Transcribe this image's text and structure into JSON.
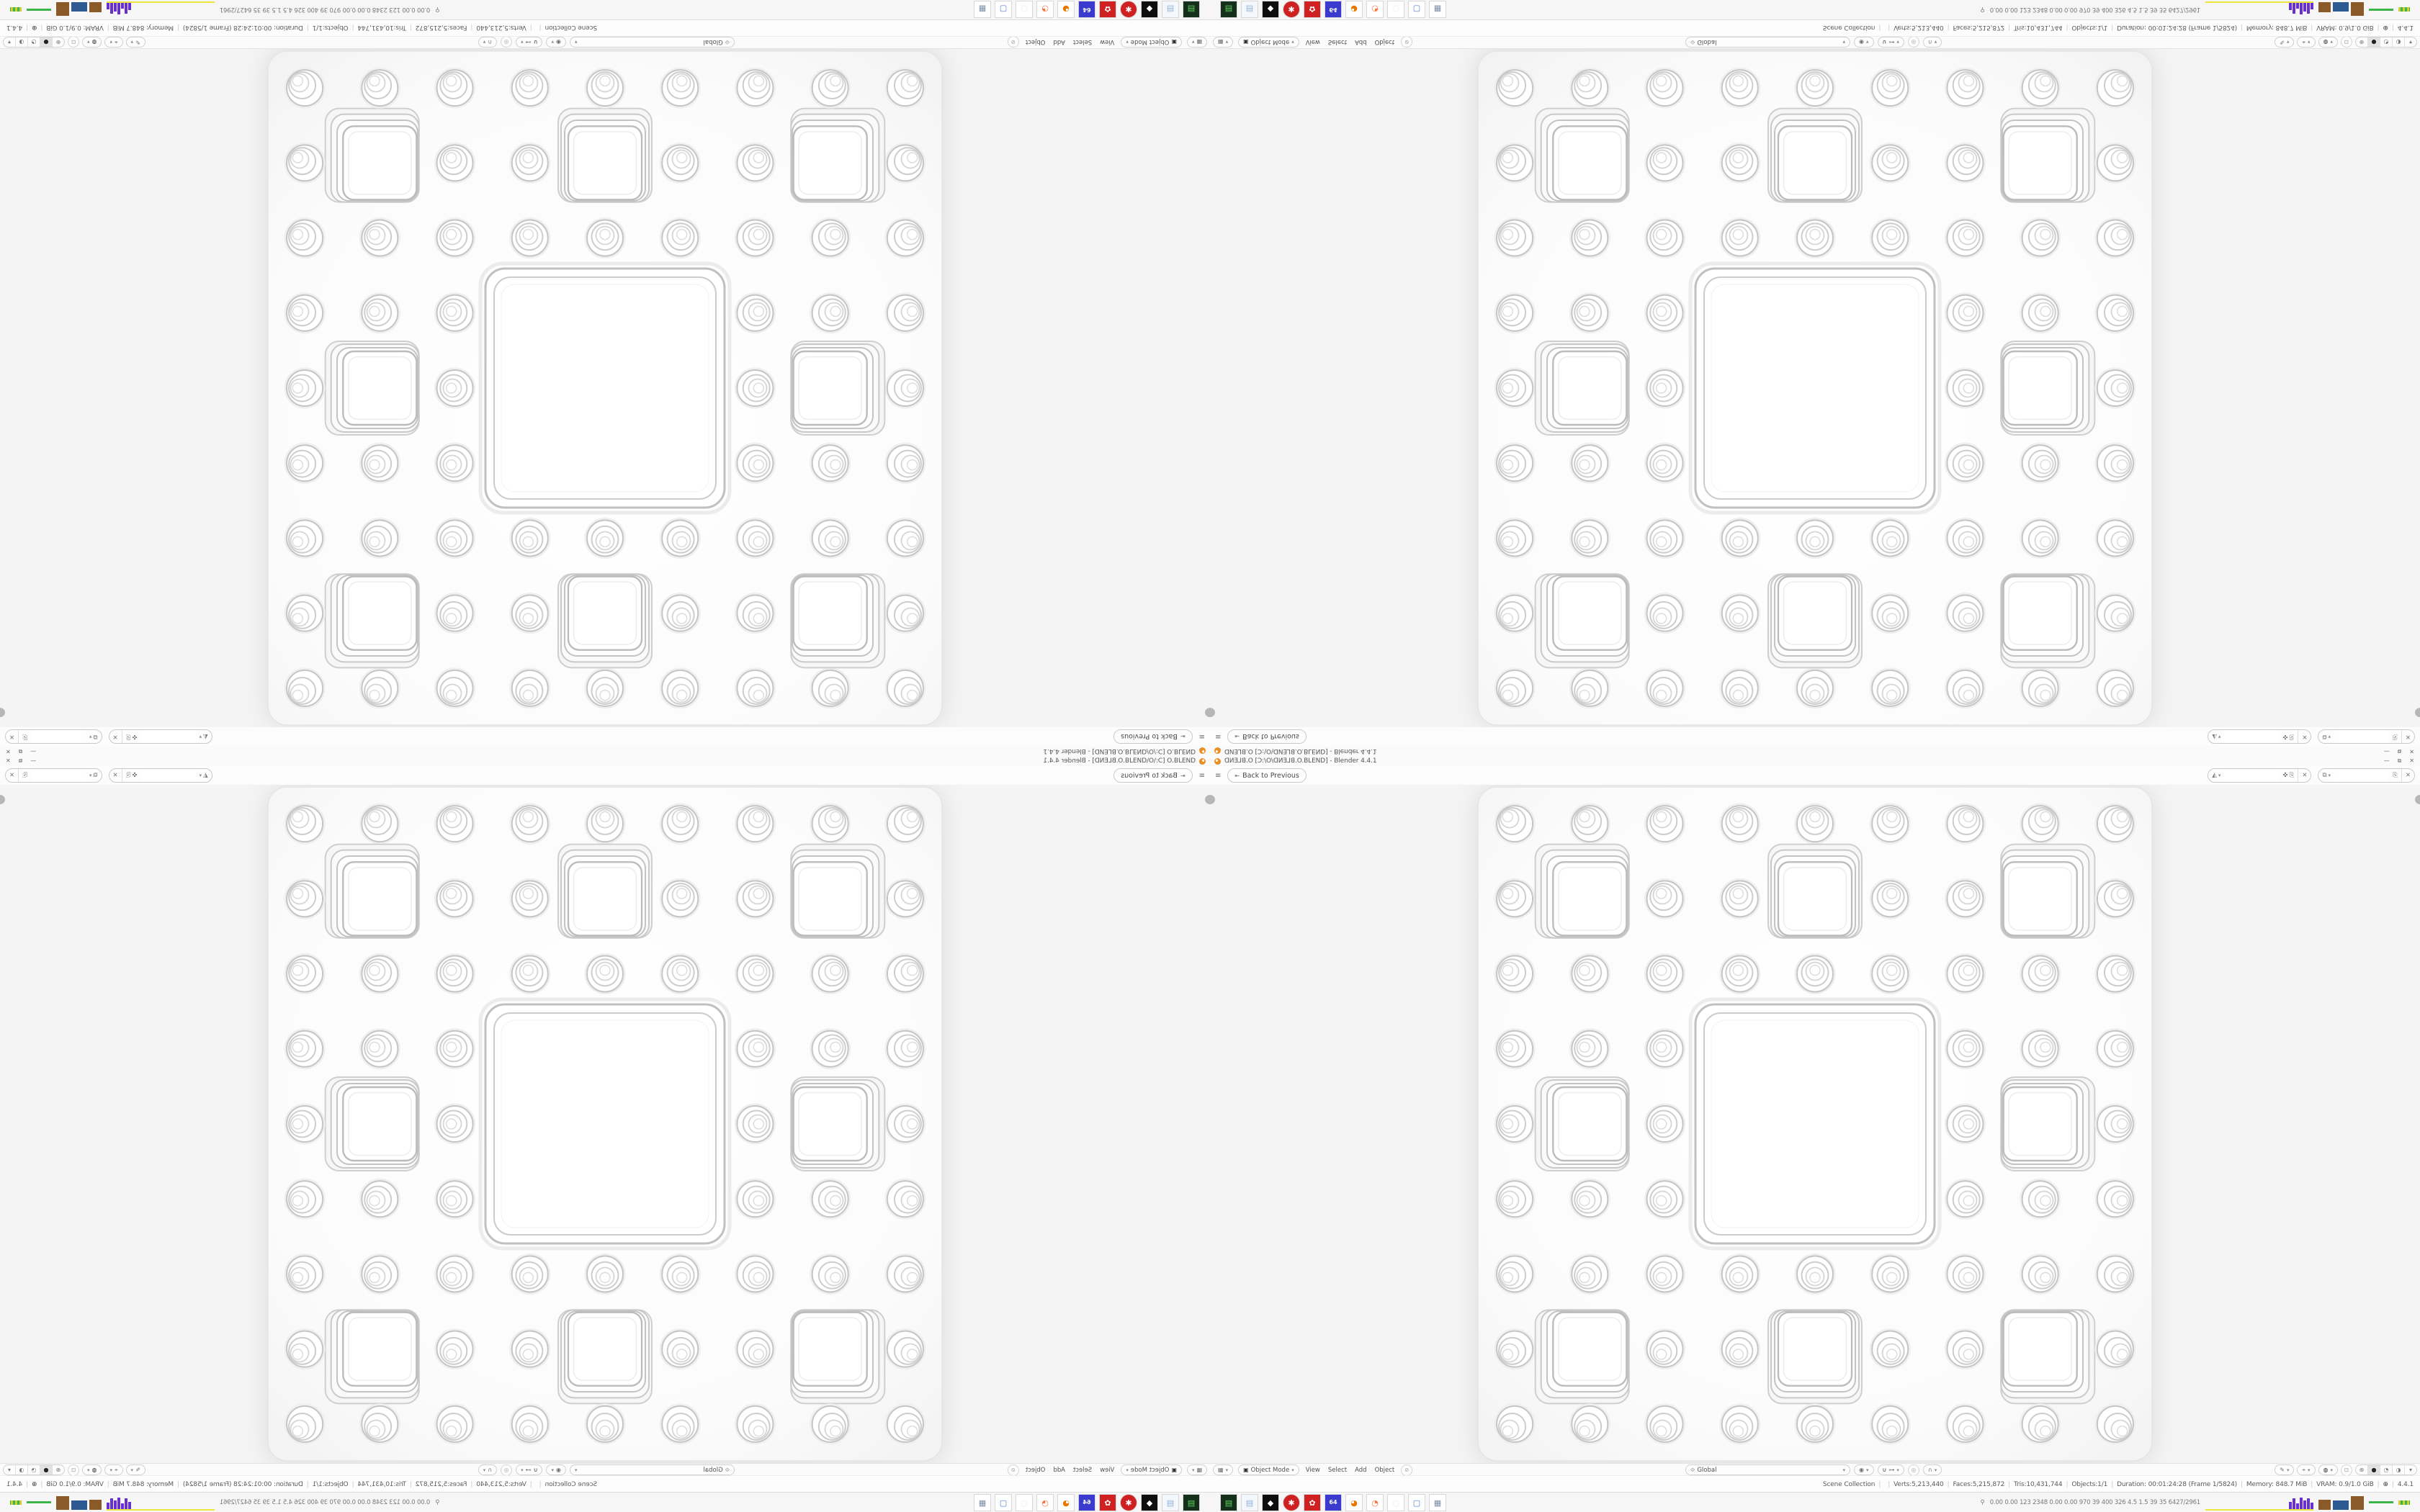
{
  "window": {
    "title": "ꓷИƎ⅃ꓭ.O [Ɔ:\\O\\ꓷИƎ⅃ꓭ.O.BLEND] - Blender 4.4.1",
    "controls": {
      "minimize": "—",
      "restore": "⧉",
      "close": "✕"
    }
  },
  "topbar": {
    "back_label": "Back to Previous",
    "scene_selector": {
      "value": "",
      "placeholder": ""
    },
    "view_layer_selector": {
      "value": "",
      "placeholder": ""
    }
  },
  "viewport_header": {
    "mode": "Object Mode",
    "menus": [
      {
        "label": "View"
      },
      {
        "label": "Select"
      },
      {
        "label": "Add"
      },
      {
        "label": "Object"
      }
    ],
    "orientation": "Global"
  },
  "statusbar": {
    "items": [
      "Scene Collection",
      "",
      "Verts:5,213,440",
      "Faces:5,215,872",
      "Tris:10,431,744",
      "Objects:1/1",
      "Duration: 00:01:24:28 (Frame 1/5824)",
      "Memory: 848.7 MiB",
      "VRAM: 0.9/1.0 GiB"
    ],
    "version": "4.4.1"
  },
  "taskbar": {
    "apps": [
      {
        "name": "disk-utility-icon",
        "glyph": "▤"
      },
      {
        "name": "notepad-icon",
        "glyph": "▤"
      },
      {
        "name": "graphics-app-icon",
        "glyph": "◆"
      },
      {
        "name": "red-gear-app-icon",
        "glyph": "✱"
      },
      {
        "name": "red-settings-app-icon",
        "glyph": "✿"
      },
      {
        "name": "floppy-64-icon",
        "glyph": "64"
      },
      {
        "name": "blender-icon",
        "glyph": "◕"
      },
      {
        "name": "firefox-icon",
        "glyph": "◔"
      },
      {
        "name": "ghost-app-icon",
        "glyph": "○"
      },
      {
        "name": "display-app-icon",
        "glyph": "▢"
      },
      {
        "name": "calculator-icon",
        "glyph": "▦"
      }
    ],
    "tray": {
      "person_glyph": "⚲",
      "stats_text": "0.00 0.00  123  2348 0.00 0.00  970   39   400   326   4.5   1.5   39   35  6427/2961"
    }
  },
  "icons": {
    "hamburger": "≡",
    "back_arrow": "⇤",
    "scene": "◭",
    "view_layer": "⧉",
    "pin": "✜",
    "copy": "⎘",
    "unlink": "✕",
    "chevron": "▾",
    "editor_type": "▦",
    "mode_icon": "▣",
    "tool_circle": "⊘",
    "orientation": "⟐",
    "pivot": "◉",
    "snap_magnet": "∪",
    "snap_target": "⊶",
    "proportional": "◎",
    "falloff": "∩",
    "annotate": "✎",
    "gizmo": "⌖",
    "overlays": "◍",
    "xray": "⊡",
    "shade_wireframe": "⊕",
    "shade_solid": "●",
    "shade_material": "◔",
    "shade_rendered": "◑",
    "globe": "⊕"
  },
  "colors": {
    "blender_orange": "#ef8f1f",
    "viewport_bg": "#f4f4f4",
    "chrome_bg": "#fbfbfb",
    "pill_border": "#c9c9c9",
    "tray_purple": "#6a2fd0",
    "tray_yellow": "#ece73c",
    "tray_brown": "#8a5a28",
    "tray_blue": "#2e5a94",
    "tray_green": "#3db54a"
  }
}
